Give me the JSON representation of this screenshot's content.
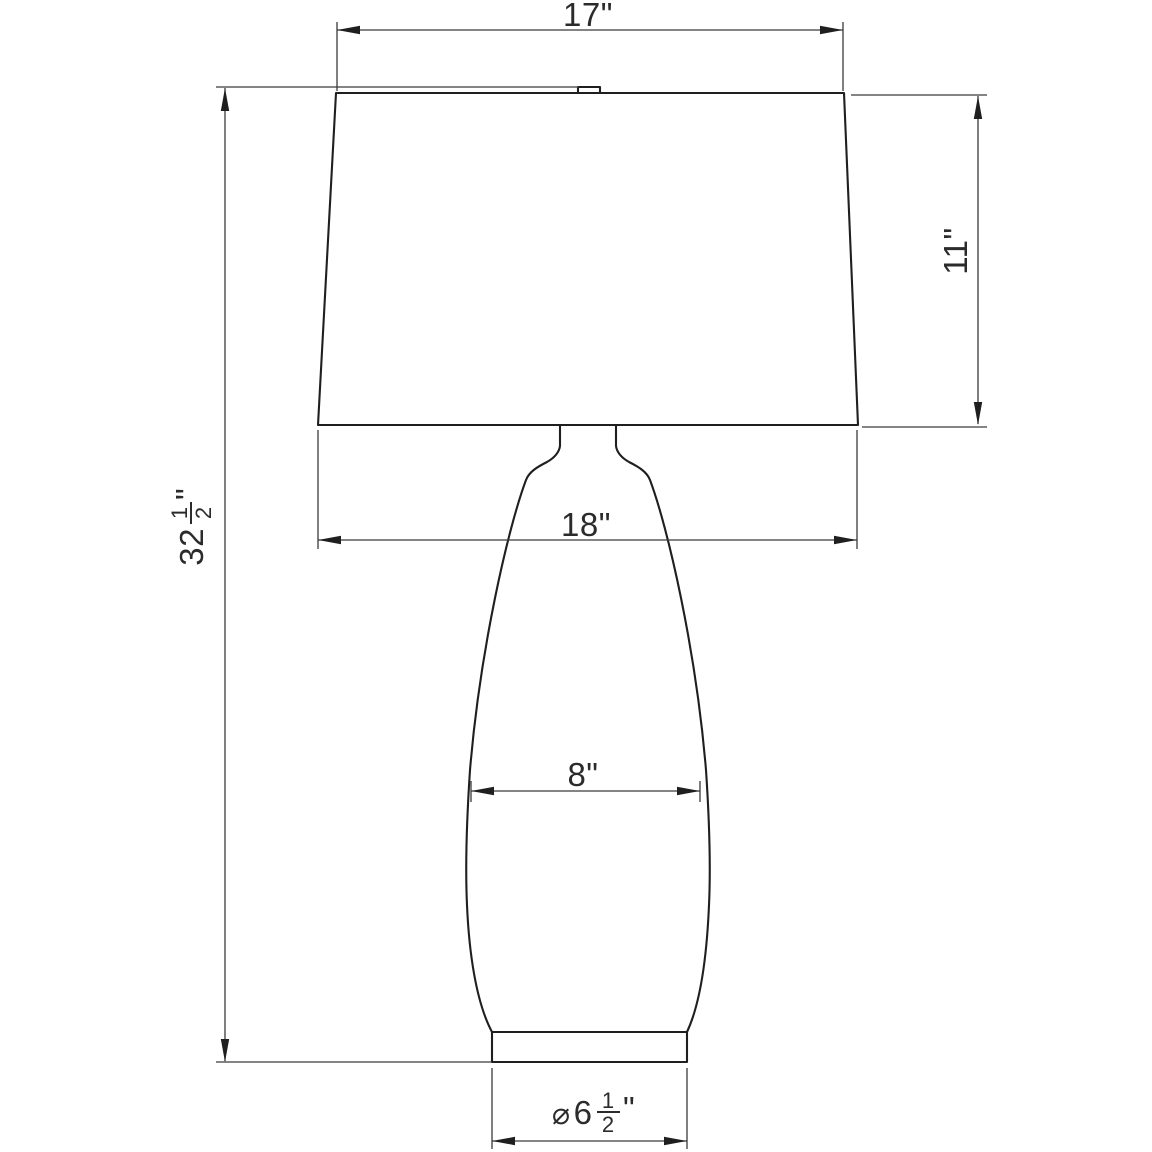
{
  "diagram": {
    "kind": "technical-line-drawing",
    "subject": "table lamp front elevation with tapered drum shade, vase body and plinth base",
    "units": "inches"
  },
  "colors": {
    "background": "#ffffff",
    "outline": "#1f1f1f",
    "dimension_lines": "#3a3a3a",
    "text": "#2b2b2b"
  },
  "dimensions": {
    "shade_top_width": {
      "label": "17\"",
      "inches": 17
    },
    "shade_height": {
      "label": "11\"",
      "inches": 11
    },
    "shade_bottom_width": {
      "label": "18\"",
      "inches": 18
    },
    "body_width": {
      "label": "8\"",
      "inches": 8
    },
    "total_height": {
      "whole": "32",
      "numerator": "1",
      "denominator": "2",
      "unit": "\"",
      "inches": 32.5
    },
    "base_diameter": {
      "symbol": "⌀",
      "whole": "6",
      "numerator": "1",
      "denominator": "2",
      "unit": "\"",
      "inches": 6.5
    }
  }
}
